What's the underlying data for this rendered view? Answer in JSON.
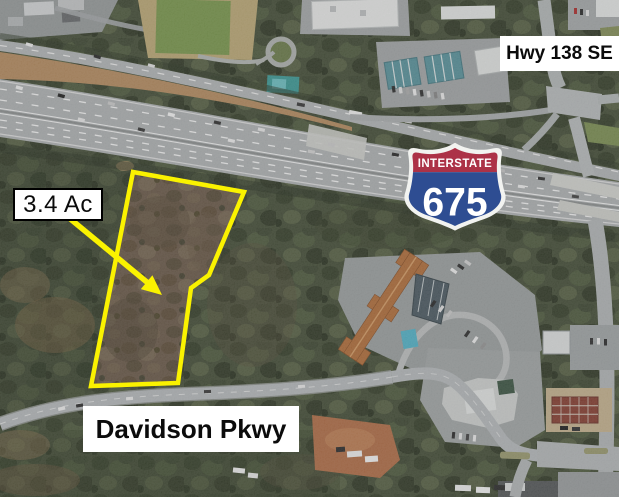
{
  "annotations": {
    "parcel_area_label": "3.4 Ac",
    "hwy_label": "Hwy 138 SE",
    "parkway_label": "Davidson Pkwy",
    "interstate_shield": {
      "header": "INTERSTATE",
      "number": "675"
    }
  },
  "colors": {
    "parcel_outline": "#FAF200",
    "shield_red": "#AC3247",
    "shield_blue": "#2E4D92",
    "shield_white": "#F2F3F0",
    "label_bg": "#FFFFFF",
    "label_text": "#0B0B0B"
  },
  "map": {
    "type": "aerial-site-exhibit"
  }
}
